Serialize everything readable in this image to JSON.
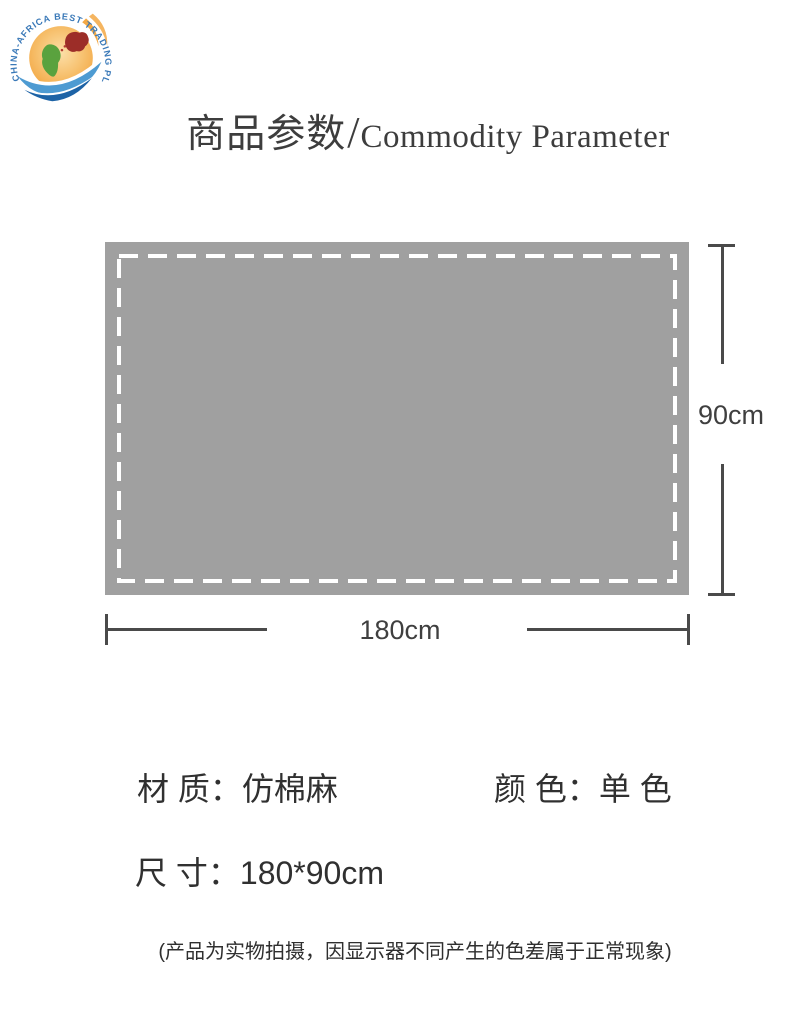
{
  "logo": {
    "ring_text": "CHINA-AFRICA BEST TRADING PLATFORM",
    "colors": {
      "ring_text": "#3a79b8",
      "globe_light": "#fcdfa8",
      "globe_orange": "#f3a844",
      "africa_green": "#5aa23e",
      "china_red": "#9c2d28",
      "wave_light": "#4e9bd2",
      "wave_dark": "#1d63a6"
    }
  },
  "header": {
    "title_zh": "商品参数",
    "separator": "/",
    "title_en": "Commodity Parameter"
  },
  "diagram": {
    "fabric_color": "#a0a0a0",
    "dash_border_color": "#ffffff",
    "line_color": "#4a4a4a",
    "height_label": "90cm",
    "width_label": "180cm"
  },
  "specs": {
    "material": {
      "label": "材 质：",
      "value": "仿棉麻"
    },
    "color": {
      "label": "颜 色：",
      "value": "单 色"
    },
    "size": {
      "label": "尺 寸：",
      "value": "180*90cm"
    }
  },
  "disclaimer": "(产品为实物拍摄，因显示器不同产生的色差属于正常现象)"
}
